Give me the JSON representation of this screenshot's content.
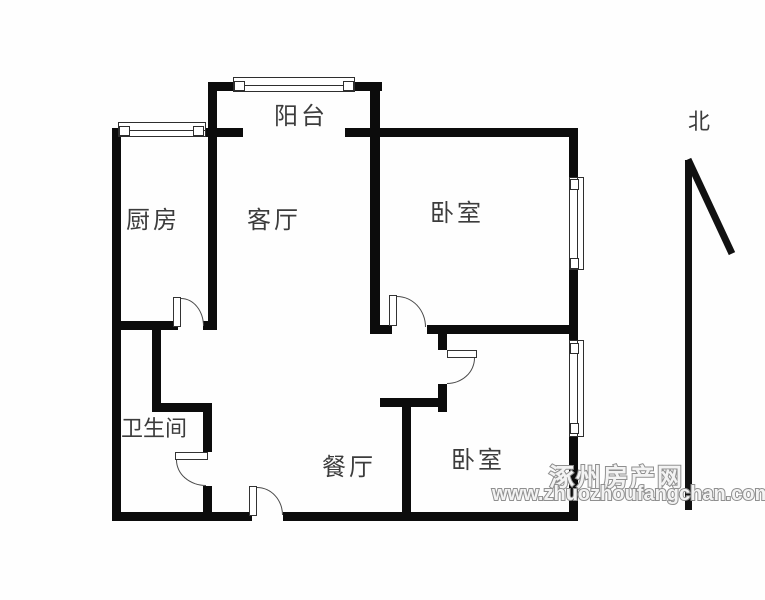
{
  "canvas": {
    "background": "#fefefe",
    "wall_color": "#0c0c0c"
  },
  "rooms": {
    "balcony": {
      "label": "阳台"
    },
    "kitchen": {
      "label": "厨房"
    },
    "living": {
      "label": "客厅"
    },
    "bedroom_north": {
      "label": "卧室"
    },
    "bathroom": {
      "label": "卫生间"
    },
    "dining": {
      "label": "餐厅"
    },
    "bedroom_south": {
      "label": "卧室"
    }
  },
  "compass": {
    "label": "北"
  },
  "watermark": {
    "line1": "涿州房产网",
    "line2": "www.zhuozhoufangchan.com"
  }
}
